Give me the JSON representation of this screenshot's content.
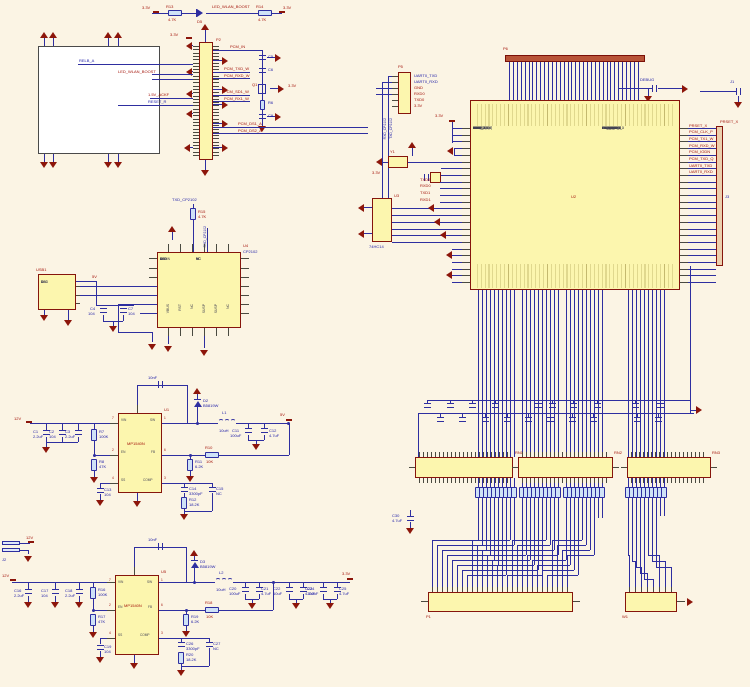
{
  "colors": {
    "wire": "#2e2ea0",
    "component_fill": "#fcf6ae",
    "component_border": "#86150c",
    "symbol": "#8c150a",
    "background": "#fbf4e4"
  },
  "power": {
    "v33": "3.3V",
    "v12": "12V",
    "v5": "5V",
    "gnd": "GND"
  },
  "led": {
    "r1_ref": "R13",
    "r1_val": "4.7K",
    "d_ref": "D5",
    "net": "LED_WLAN_BOOST",
    "r2_ref": "R14",
    "r2_val": "4.7K"
  },
  "module": {
    "header_ref": "P2",
    "net_relb": "RELB_A",
    "net_led": "LED_WLAN_BOOST",
    "net_ack": "1.5V_ACKF",
    "net_reset": "RESET_R",
    "right_nets": [
      "PCM_IN",
      "PCM_TXD_W",
      "PCM_RXD_W",
      "PCM_SD1_W",
      "PCM_RX1_W"
    ],
    "long_nets": [
      "PCM_DS1_A",
      "PCM_DS2_A"
    ],
    "cap_refs": [
      "C5",
      "C6"
    ],
    "q_ref": "Q1",
    "r_ref": "R6",
    "c_ref": "C9"
  },
  "cp2102": {
    "ref": "U4",
    "part": "CP2102",
    "net_txd": "TXD_CP2102",
    "net_rxd": "RXD_CP2102",
    "r_ref": "R15",
    "r_val": "4.7K",
    "left_pins": [
      "DCD",
      "RI",
      "GND",
      "D+",
      "D-",
      "VDD",
      "REGIN"
    ],
    "right_pins": [
      "NC",
      "NC",
      "NC",
      "NC",
      "NC",
      "NC",
      "NC"
    ],
    "bottom_pins": [
      "VBUS",
      "RST",
      "NC",
      "SUSP",
      "SUSP",
      "NC"
    ]
  },
  "usb": {
    "ref": "USB1",
    "rail": "5V",
    "pins": [
      "VCC",
      "D-",
      "D+",
      "GND"
    ],
    "c1": [
      "C4",
      "104"
    ],
    "c2": [
      "C7",
      "104"
    ]
  },
  "reg1": {
    "ref": "U1",
    "part": "MP1540N",
    "out": "5V",
    "pins_l": [
      "VIN",
      "EN",
      "SS"
    ],
    "pins_r": [
      "SW",
      "FB",
      "COMP"
    ],
    "pnums_l": [
      "7",
      "2",
      "4"
    ],
    "pnums_r": [
      "1",
      "6",
      "3"
    ],
    "c_top": "10nF",
    "c_in": [
      [
        "C1",
        "2.2uF"
      ],
      [
        "C2",
        "104"
      ],
      [
        "C3",
        "2.2uF"
      ]
    ],
    "r_en": [
      "R7",
      "100K"
    ],
    "r_en2": [
      "R8",
      "47K"
    ],
    "c_ss": [
      "C13",
      "104"
    ],
    "d": [
      "D2",
      "B5819W"
    ],
    "l_ref": "L1",
    "l_val": "10uH",
    "c_out": [
      [
        "C11",
        "100uF"
      ],
      [
        "C12",
        "4.7uF"
      ]
    ],
    "r_fb": [
      "R10",
      "10K"
    ],
    "r_fb2": [
      "R11",
      "6.2K"
    ],
    "c_comp": [
      "C14",
      "3300pF"
    ],
    "r_comp": [
      "R12",
      "18.2K"
    ],
    "c_nc": [
      "C15",
      "NC"
    ]
  },
  "reg2": {
    "ref": "U5",
    "part": "MP1540N",
    "out": "3.3V",
    "jack_ref": "J2",
    "pins_l": [
      "VIN",
      "EN",
      "SS"
    ],
    "pins_r": [
      "SW",
      "FB",
      "COMP"
    ],
    "pnums_l": [
      "7",
      "2",
      "4"
    ],
    "pnums_r": [
      "1",
      "6",
      "3"
    ],
    "c_top": "10nF",
    "c_in": [
      [
        "C16",
        "2.2uF"
      ],
      [
        "C17",
        "104"
      ],
      [
        "C18",
        "2.2uF"
      ]
    ],
    "r_en": [
      "R16",
      "100K"
    ],
    "r_en2": [
      "R17",
      "47K"
    ],
    "c_ss": [
      "C19",
      "104"
    ],
    "d": [
      "D3",
      "B5819W"
    ],
    "l_ref": "L2",
    "l_val": "10uH",
    "c_out": [
      [
        "C20",
        "100uF"
      ],
      [
        "C21",
        "4.7uF"
      ],
      [
        "C22",
        "10uF"
      ],
      [
        "C23",
        "4.7uF"
      ],
      [
        "C24",
        "100uF"
      ],
      [
        "C25",
        "4.7uF"
      ]
    ],
    "r_fb": [
      "R18",
      "10K"
    ],
    "r_fb2": [
      "R19",
      "6.2K"
    ],
    "c_comp": [
      "C26",
      "3300pF"
    ],
    "r_comp": [
      "R20",
      "18.2K"
    ],
    "c_nc": [
      "C27",
      "NC"
    ]
  },
  "p5": {
    "ref": "P5",
    "nets": [
      "UART0_TXD",
      "UART0_RXD",
      "GND",
      "RXD0",
      "TXD0",
      "3.3V"
    ],
    "vert_nets": [
      "TXD_CP2102",
      "RXD_CP2102"
    ]
  },
  "mcu": {
    "ref": "U2",
    "top_bar_ref": "P6",
    "right_bar_ref": "J3",
    "debug_net": "DEBUG",
    "j1": "J1",
    "y1": "Y1",
    "u3": "U3",
    "u3_part": "74HC14",
    "net_top_right": "PRSET_X",
    "left_nets": [
      "TXD0",
      "RXD0",
      "TXD1",
      "RXD1"
    ],
    "left_pins": [
      "3.3VD",
      "3.3VD",
      "3.3VD",
      "GND",
      "GND",
      "CTAG_X",
      "TXD2",
      "RXD2",
      "TXD3",
      "RXD3",
      "RTS0_X",
      "WTMAX_IRQ",
      "RTN0_X",
      "CAN_TAG_IF",
      "GND",
      "UART_TXD",
      "UART_RXD",
      "UART_XD0",
      "GND",
      "3.3VA",
      "AVDD",
      "GND",
      "AVDD",
      "GND"
    ],
    "right_pins": [
      "PRINT_X",
      "XECN",
      "PCM_OUT_P",
      "PCM_TX1_W",
      "PCM_RXD5",
      "PCM_IODN",
      "PCM_TXD_O",
      "DC_CLK",
      "DC_XCLK",
      "DIDR_PORT_X",
      "UARTN_TXD",
      "UARTN_RXD",
      "GND",
      "OK_XVCLK",
      "OK_AVDY",
      "OK_DVDN",
      "OK_TODY",
      "OK_XDD",
      "OK_AVDD",
      "OK_TXCLK",
      "OK_TXD4",
      "OK_TDRS",
      "OK_MDV",
      "RW_IN_LBD_1"
    ],
    "right_nets": [
      "PRSET_X",
      "PCM_CLK_P",
      "PCM_TX1_W",
      "PCM_RXD_W",
      "PCM_IODN",
      "PCM_TXD_Q",
      "UART0_TXD",
      "UART0_RXD"
    ]
  },
  "bus": {
    "rn1": "RN1",
    "rn2": "RN2",
    "rn3": "RN3",
    "p1": "P1",
    "w1": "W1",
    "c30": [
      "C30",
      "4.7uF"
    ]
  }
}
